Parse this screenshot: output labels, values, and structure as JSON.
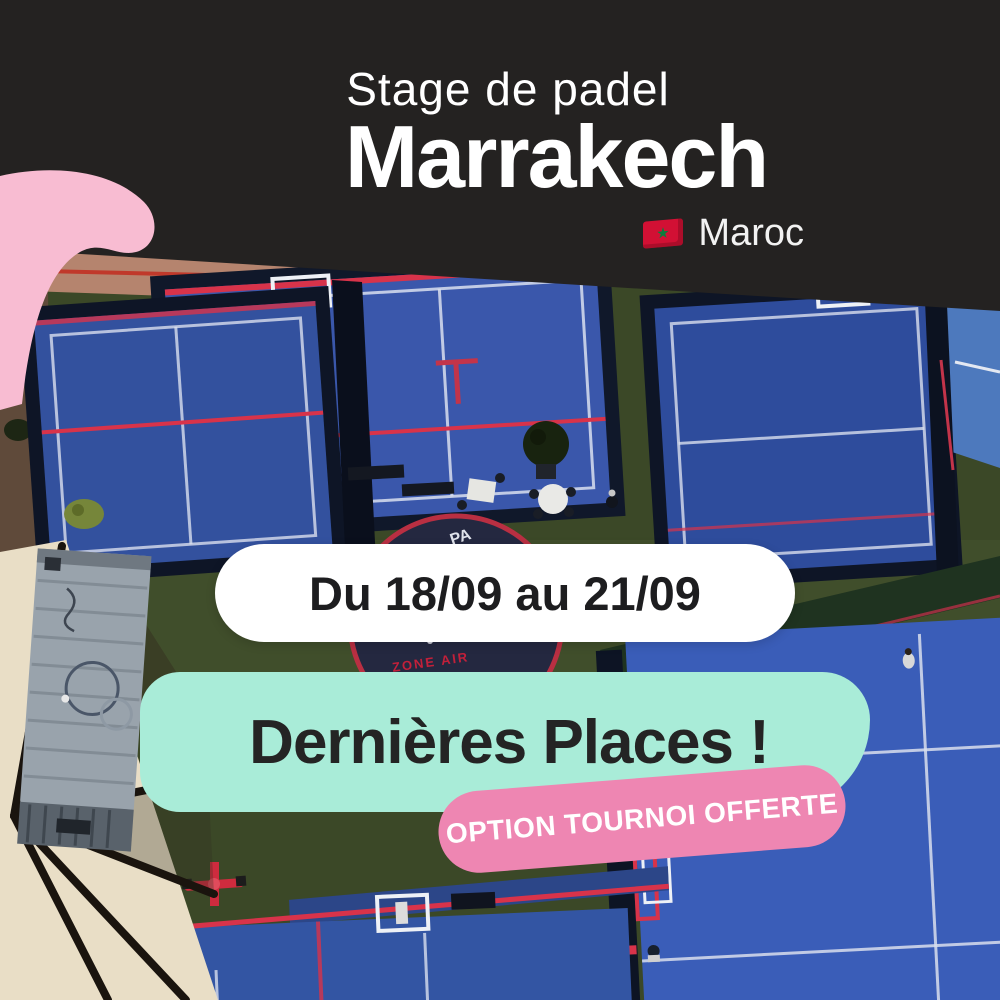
{
  "poster": {
    "header": {
      "subtitle": "Stage de padel",
      "title": "Marrakech",
      "country": "Maroc",
      "flag_star_glyph": "★"
    },
    "badges": {
      "dates": "Du 18/09 au 21/09",
      "availability": "Dernières Places !",
      "offer": "OPTION TOURNOI OFFERTE"
    },
    "photo": {
      "dome_label": "PA",
      "zone_air_label": "ZONE AIR"
    },
    "palette": {
      "header_bg": "#242221",
      "text_light": "#ffffff",
      "text_dark": "#232323",
      "mint": "#a9ecd8",
      "pink_badge": "#ee86b2",
      "pink_shape": "#f8bcd2",
      "court_blue": "#3a57ab",
      "court_blue_light": "#4d79bd",
      "turf_green": "#3d4a2b",
      "line_red": "#d8334a",
      "flag_red": "#d21034",
      "flag_star": "#0a7d3c"
    }
  }
}
